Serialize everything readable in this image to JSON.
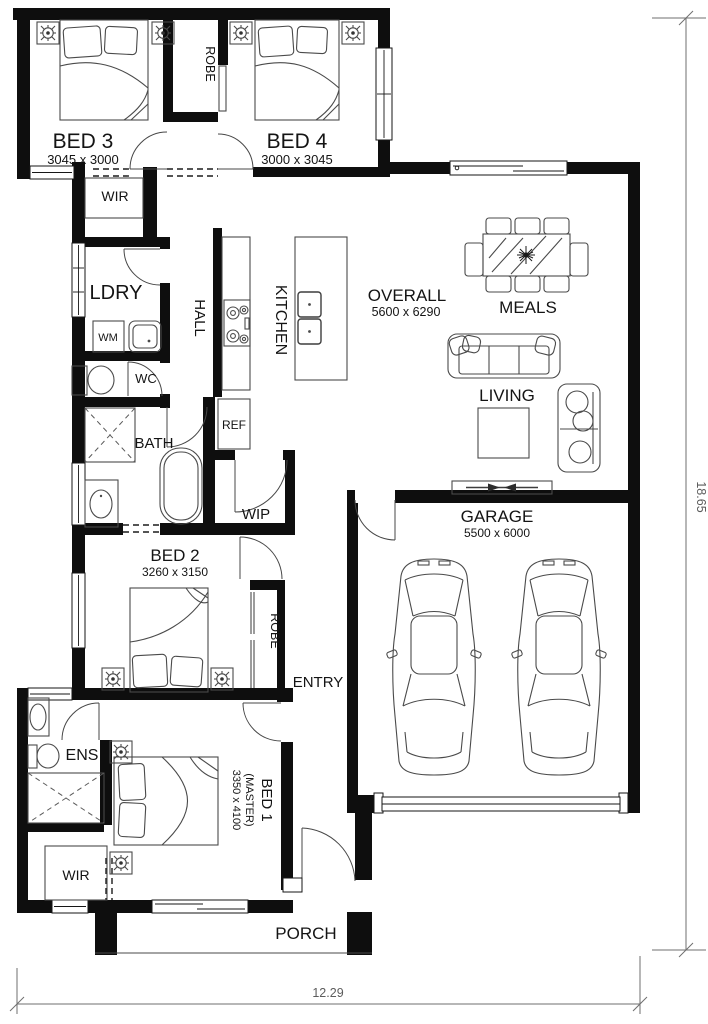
{
  "plan": {
    "rooms": {
      "bed3": {
        "name": "BED 3",
        "dims": "3045 x 3000"
      },
      "bed4": {
        "name": "BED 4",
        "dims": "3000 x 3045"
      },
      "robe_top": {
        "name": "ROBE"
      },
      "wir_top": {
        "name": "WIR"
      },
      "ldry": {
        "name": "LDRY"
      },
      "hall": {
        "name": "HALL"
      },
      "kitchen": {
        "name": "KITCHEN"
      },
      "wc": {
        "name": "WC"
      },
      "bath": {
        "name": "BATH"
      },
      "wip": {
        "name": "WIP"
      },
      "overall": {
        "name": "OVERALL",
        "dims": "5600 x 6290"
      },
      "meals": {
        "name": "MEALS"
      },
      "living": {
        "name": "LIVING"
      },
      "bed2": {
        "name": "BED 2",
        "dims": "3260 x 3150"
      },
      "robe_bed2": {
        "name": "ROBE"
      },
      "entry": {
        "name": "ENTRY"
      },
      "garage": {
        "name": "GARAGE",
        "dims": "5500 x 6000"
      },
      "ens": {
        "name": "ENS"
      },
      "bed1": {
        "name": "BED 1",
        "sub": "(MASTER)",
        "dims": "3350 x 4100"
      },
      "wir_bed1": {
        "name": "WIR"
      },
      "porch": {
        "name": "PORCH"
      }
    },
    "fixtures": {
      "wm": "WM",
      "ref": "REF"
    },
    "overall_dimensions": {
      "depth_m": "18.65",
      "width_m": "12.29"
    },
    "colors": {
      "wall": "#0e0e0e",
      "furniture_line": "#4a4a4a",
      "dimension_line": "#6f6f6f",
      "background": "#ffffff"
    }
  }
}
